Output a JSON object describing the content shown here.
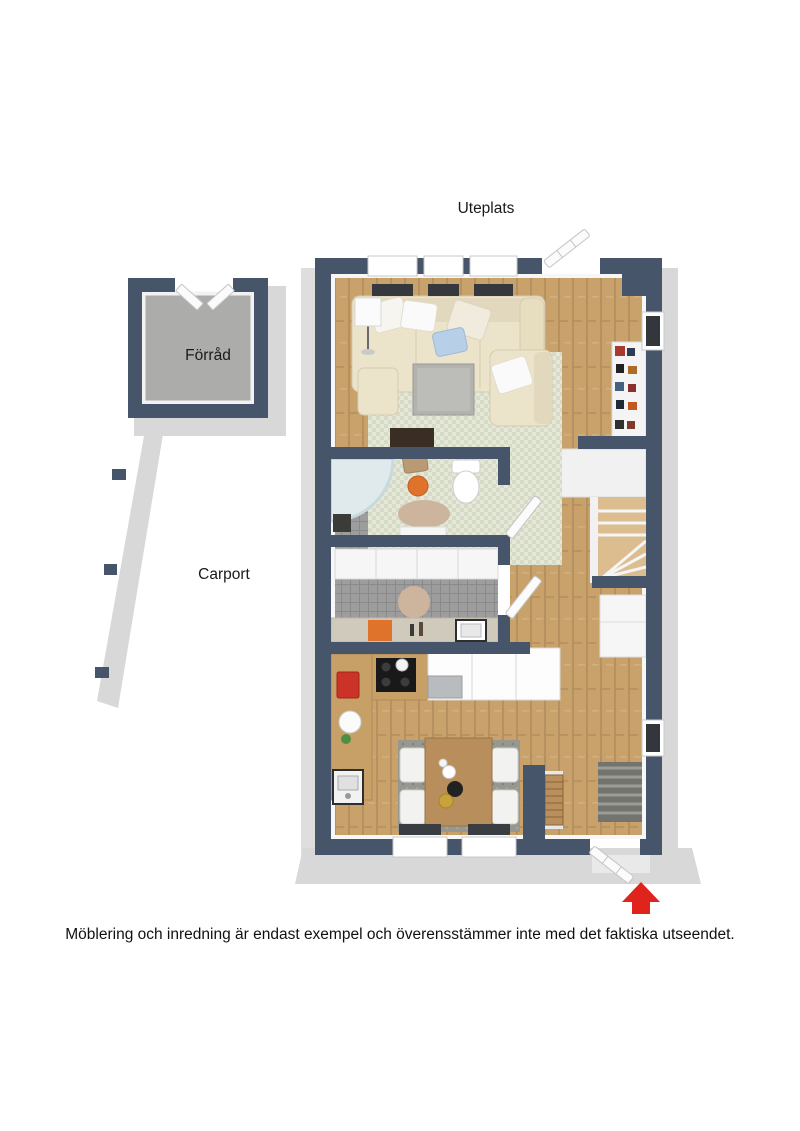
{
  "labels": {
    "uteplats": "Uteplats",
    "forrad": "Förråd",
    "carport": "Carport"
  },
  "disclaimer": "Möblering och inredning är endast exempel och överensstämmer inte med det faktiska utseendet.",
  "colors": {
    "wall": "#46556a",
    "wood_floor": "#c9a26b",
    "stair_wood": "#dcbd90",
    "tile_floor": "#9c9d9c",
    "concrete_floor": "#acacaa",
    "exterior_concrete": "#d8d8d8",
    "rug_green": "#e4e8d7",
    "rug_gray": "#97978f",
    "round_rug_beige": "#cdb59d",
    "sofa_cream": "#ece3cb",
    "pillow_blue": "#b7cfe7",
    "accent_orange": "#e0732c",
    "appliance_red": "#cc3328",
    "entrance_arrow_red": "#e0241c",
    "label_text": "#1a1a1a"
  },
  "icons": {
    "entrance_arrow": "▲"
  }
}
